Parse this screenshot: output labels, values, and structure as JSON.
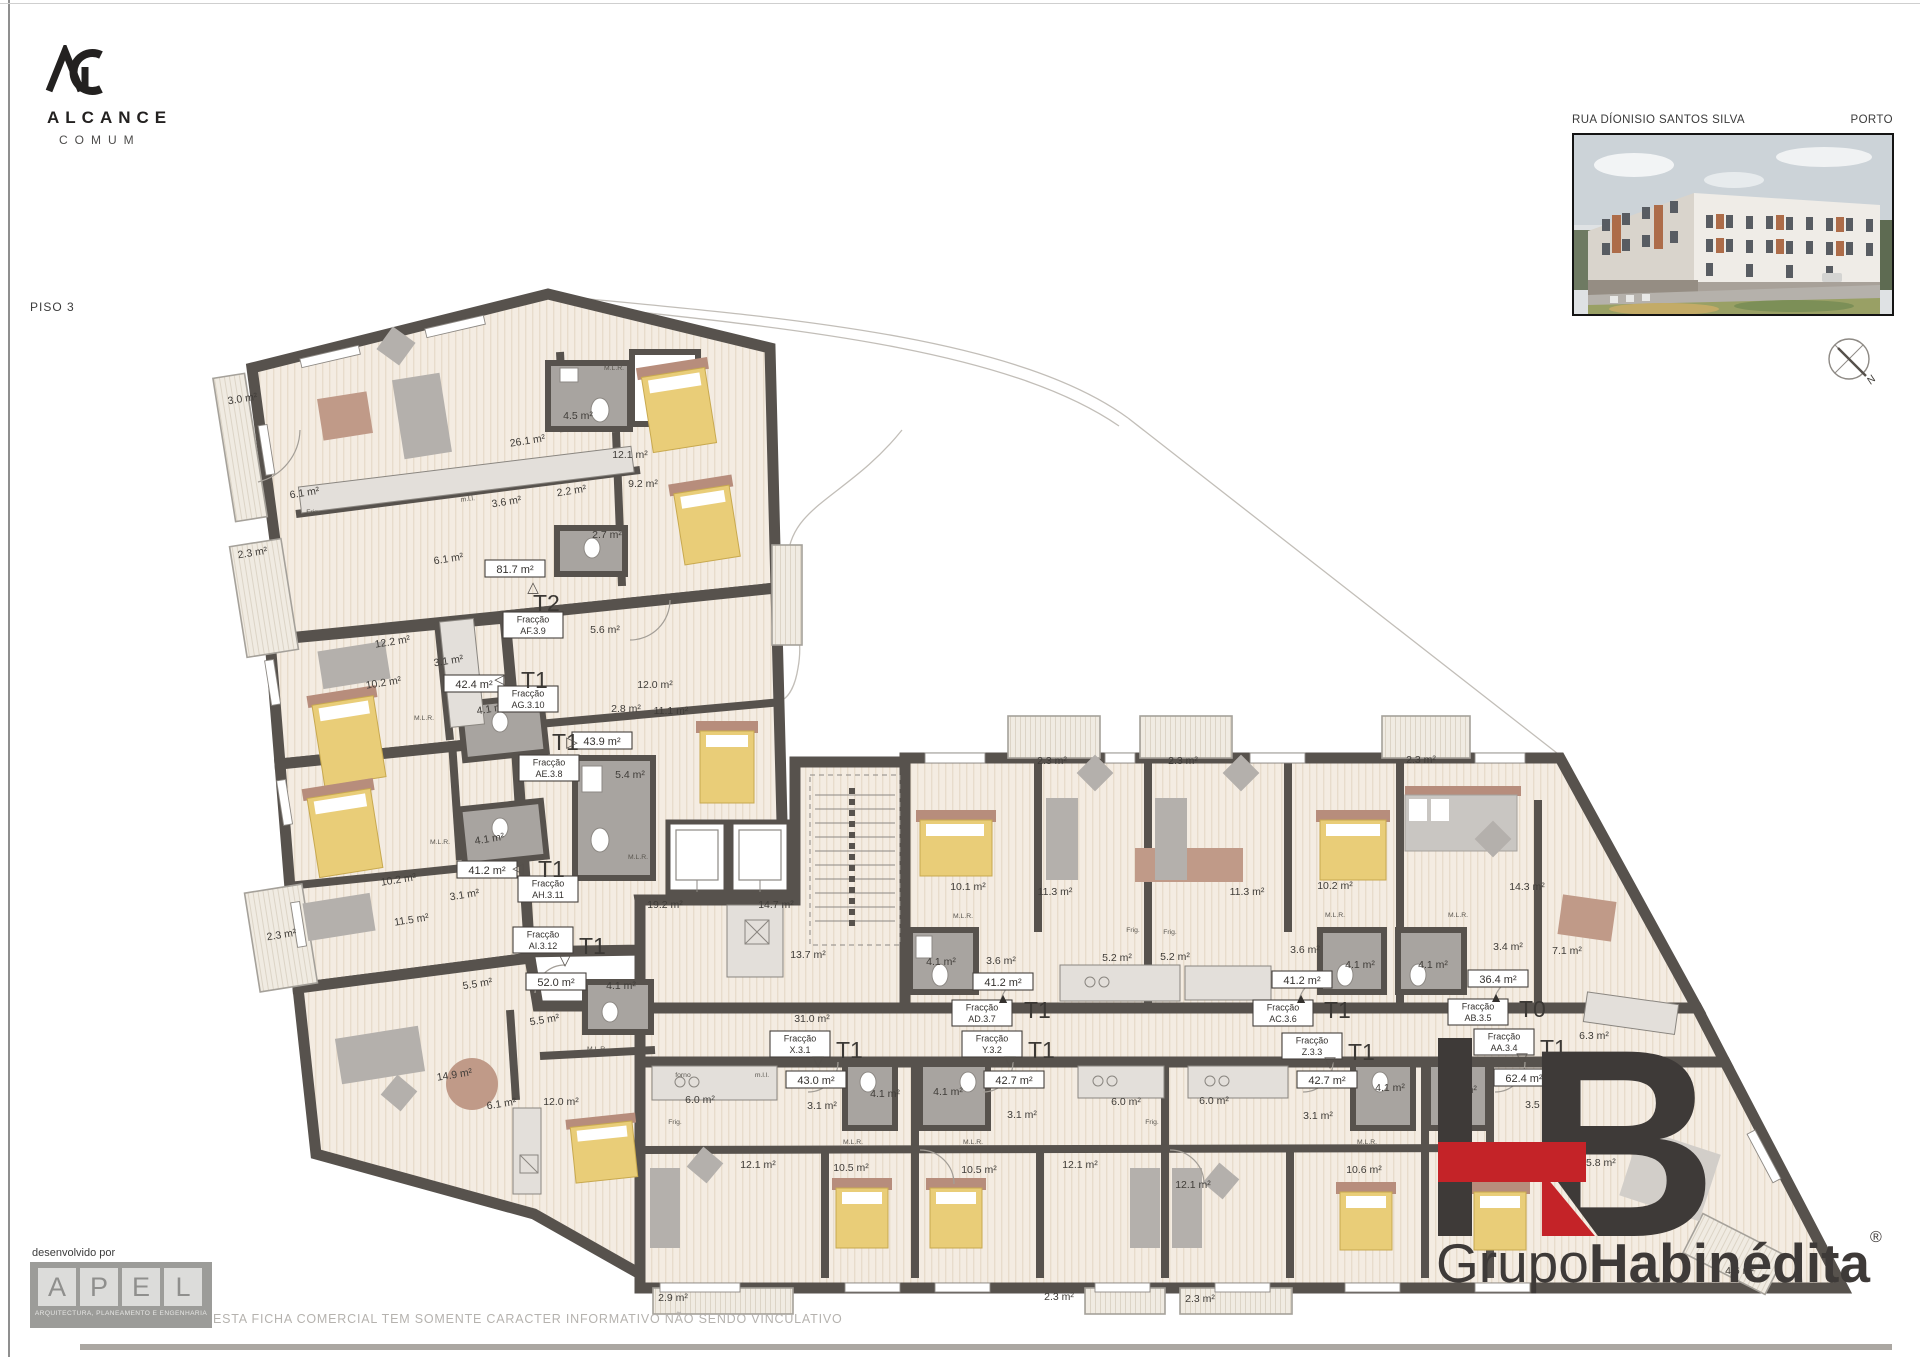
{
  "branding": {
    "monogram": "AC",
    "name": "ALCANCE",
    "subname": "COMUM"
  },
  "sheet": {
    "floor_label": "PISO 3",
    "street": "RUA DÍONISIO SANTOS SILVA",
    "city": "PORTO",
    "compass_label": "N"
  },
  "developer": {
    "label": "desenvolvido por",
    "caption": "ARQUITECTURA, PLANEAMENTO E ENGENHARIA",
    "letters": [
      "A",
      "P",
      "E",
      "L"
    ]
  },
  "legal": {
    "disclaimer": "ESTA FICHA COMERCIAL TEM SOMENTE CARACTER INFORMATIVO NÃO SENDO VINCULATIVO"
  },
  "footer_brand": {
    "monogram": "HB",
    "prefix": "Grupo",
    "name": "Habinédita",
    "registered": "®",
    "accent_color": "#c42328",
    "dark_color": "#3e3a38"
  },
  "plan": {
    "frac_word": "Fracção",
    "units": [
      {
        "code": "AF.3.9",
        "t": "T2",
        "area": "81.7 m²",
        "ax": 515,
        "ay": 569,
        "fx": 533,
        "fy": 625,
        "tx": 533,
        "ty": 603,
        "g": "△",
        "gx": 533,
        "gy": 587,
        "filled": false
      },
      {
        "code": "AG.3.10",
        "t": "T1",
        "area": "42.4 m²",
        "ax": 474,
        "ay": 684,
        "fx": 528,
        "fy": 699,
        "tx": 521,
        "ty": 680,
        "g": "◁",
        "gx": 500,
        "gy": 679,
        "filled": false
      },
      {
        "code": "AE.3.8",
        "t": "T1",
        "area": "43.9 m²",
        "ax": 602,
        "ay": 741,
        "fx": 549,
        "fy": 768,
        "tx": 552,
        "ty": 742,
        "g": "▷",
        "gx": 572,
        "gy": 742,
        "filled": false
      },
      {
        "code": "AH.3.11",
        "t": "T1",
        "area": "41.2 m²",
        "ax": 487,
        "ay": 870,
        "fx": 548,
        "fy": 889,
        "tx": 538,
        "ty": 869,
        "g": "◁",
        "gx": 518,
        "gy": 868,
        "filled": false
      },
      {
        "code": "AI.3.12",
        "t": "T1",
        "area": "52.0 m²",
        "ax": 556,
        "ay": 982,
        "fx": 543,
        "fy": 940,
        "tx": 579,
        "ty": 946,
        "g": "▽",
        "gx": 565,
        "gy": 960,
        "filled": false
      },
      {
        "code": "AD.3.7",
        "t": "T1",
        "area": "41.2 m²",
        "ax": 1003,
        "ay": 982,
        "fx": 982,
        "fy": 1013,
        "tx": 1024,
        "ty": 1010,
        "g": "▲",
        "gx": 1003,
        "gy": 998,
        "filled": true
      },
      {
        "code": "AC.3.6",
        "t": "T1",
        "area": "41.2 m²",
        "ax": 1302,
        "ay": 980,
        "fx": 1283,
        "fy": 1013,
        "tx": 1324,
        "ty": 1010,
        "g": "▲",
        "gx": 1301,
        "gy": 998,
        "filled": true
      },
      {
        "code": "AB.3.5",
        "t": "T0",
        "area": "36.4 m²",
        "ax": 1498,
        "ay": 979,
        "fx": 1478,
        "fy": 1012,
        "tx": 1519,
        "ty": 1009,
        "g": "▲",
        "gx": 1496,
        "gy": 997,
        "filled": true
      },
      {
        "code": "X.3.1",
        "t": "T1",
        "area": "43.0 m²",
        "ax": 816,
        "ay": 1080,
        "fx": 800,
        "fy": 1044,
        "tx": 836,
        "ty": 1050,
        "g": "▽",
        "gx": 818,
        "gy": 1061,
        "filled": false
      },
      {
        "code": "Y.3.2",
        "t": "T1",
        "area": "42.7 m²",
        "ax": 1014,
        "ay": 1080,
        "fx": 992,
        "fy": 1044,
        "tx": 1028,
        "ty": 1050,
        "g": "▽",
        "gx": 1010,
        "gy": 1061,
        "filled": false
      },
      {
        "code": "Z.3.3",
        "t": "T1",
        "area": "42.7 m²",
        "ax": 1327,
        "ay": 1080,
        "fx": 1312,
        "fy": 1046,
        "tx": 1348,
        "ty": 1052,
        "g": "▽",
        "gx": 1330,
        "gy": 1062,
        "filled": false
      },
      {
        "code": "AA.3.4",
        "t": "T1",
        "area": "62.4 m²",
        "ax": 1524,
        "ay": 1078,
        "fx": 1504,
        "fy": 1042,
        "tx": 1540,
        "ty": 1048,
        "g": "▽",
        "gx": 1522,
        "gy": 1058,
        "filled": false
      }
    ],
    "area_labels": [
      {
        "x": 243,
        "y": 402,
        "t": "3.0 m²",
        "r": -9
      },
      {
        "x": 528,
        "y": 444,
        "t": "26.1 m²",
        "r": -9
      },
      {
        "x": 578,
        "y": 419,
        "t": "4.5 m²"
      },
      {
        "x": 630,
        "y": 458,
        "t": "12.1 m²"
      },
      {
        "x": 305,
        "y": 496,
        "t": "6.1 m²",
        "r": -9
      },
      {
        "x": 507,
        "y": 505,
        "t": "3.6 m²",
        "r": -9
      },
      {
        "x": 572,
        "y": 494,
        "t": "2.2 m²",
        "r": -9
      },
      {
        "x": 643,
        "y": 487,
        "t": "9.2 m²"
      },
      {
        "x": 253,
        "y": 556,
        "t": "2.3 m²",
        "r": -9
      },
      {
        "x": 607,
        "y": 538,
        "t": "2.7 m²"
      },
      {
        "x": 449,
        "y": 562,
        "t": "6.1 m²",
        "r": -9
      },
      {
        "x": 605,
        "y": 633,
        "t": "5.6 m²"
      },
      {
        "x": 393,
        "y": 645,
        "t": "12.2 m²",
        "r": -9
      },
      {
        "x": 449,
        "y": 664,
        "t": "3.1 m²",
        "r": -9
      },
      {
        "x": 384,
        "y": 686,
        "t": "10.2 m²",
        "r": -9
      },
      {
        "x": 655,
        "y": 688,
        "t": "12.0 m²"
      },
      {
        "x": 492,
        "y": 712,
        "t": "4.1 m²",
        "r": -9
      },
      {
        "x": 626,
        "y": 712,
        "t": "2.8 m²"
      },
      {
        "x": 671,
        "y": 714,
        "t": "11.1 m²"
      },
      {
        "x": 630,
        "y": 778,
        "t": "5.4 m²"
      },
      {
        "x": 399,
        "y": 883,
        "t": "10.2 m²",
        "r": -9
      },
      {
        "x": 490,
        "y": 842,
        "t": "4.1 m²",
        "r": -9
      },
      {
        "x": 465,
        "y": 898,
        "t": "3.1 m²",
        "r": -9
      },
      {
        "x": 412,
        "y": 923,
        "t": "11.5 m²",
        "r": -9
      },
      {
        "x": 282,
        "y": 938,
        "t": "2.3 m²",
        "r": -9
      },
      {
        "x": 478,
        "y": 987,
        "t": "5.5 m²",
        "r": -9
      },
      {
        "x": 545,
        "y": 1023,
        "t": "5.5 m²",
        "r": -9
      },
      {
        "x": 621,
        "y": 989,
        "t": "4.1 m²"
      },
      {
        "x": 455,
        "y": 1078,
        "t": "14.9 m²",
        "r": -9
      },
      {
        "x": 502,
        "y": 1107,
        "t": "6.1 m²",
        "r": -9
      },
      {
        "x": 561,
        "y": 1105,
        "t": "12.0 m²"
      },
      {
        "x": 673,
        "y": 1301,
        "t": "2.9 m²"
      },
      {
        "x": 665,
        "y": 908,
        "t": "19.2 m²"
      },
      {
        "x": 776,
        "y": 908,
        "t": "14.7 m²"
      },
      {
        "x": 808,
        "y": 958,
        "t": "13.7 m²"
      },
      {
        "x": 812,
        "y": 1022,
        "t": "31.0 m²"
      },
      {
        "x": 1052,
        "y": 764,
        "t": "2.3 m²"
      },
      {
        "x": 1183,
        "y": 764,
        "t": "2.3 m²"
      },
      {
        "x": 1421,
        "y": 763,
        "t": "2.3 m²"
      },
      {
        "x": 968,
        "y": 890,
        "t": "10.1 m²"
      },
      {
        "x": 1055,
        "y": 895,
        "t": "11.3 m²"
      },
      {
        "x": 941,
        "y": 965,
        "t": "4.1 m²"
      },
      {
        "x": 1001,
        "y": 964,
        "t": "3.6 m²"
      },
      {
        "x": 1117,
        "y": 961,
        "t": "5.2 m²"
      },
      {
        "x": 1175,
        "y": 960,
        "t": "5.2 m²"
      },
      {
        "x": 1247,
        "y": 895,
        "t": "11.3 m²"
      },
      {
        "x": 1335,
        "y": 889,
        "t": "10.2 m²"
      },
      {
        "x": 1527,
        "y": 890,
        "t": "14.3 m²"
      },
      {
        "x": 1305,
        "y": 953,
        "t": "3.6 m²"
      },
      {
        "x": 1360,
        "y": 968,
        "t": "4.1 m²"
      },
      {
        "x": 1433,
        "y": 968,
        "t": "4.1 m²"
      },
      {
        "x": 1508,
        "y": 950,
        "t": "3.4 m²"
      },
      {
        "x": 1567,
        "y": 954,
        "t": "7.1 m²"
      },
      {
        "x": 700,
        "y": 1103,
        "t": "6.0 m²"
      },
      {
        "x": 822,
        "y": 1109,
        "t": "3.1 m²"
      },
      {
        "x": 885,
        "y": 1097,
        "t": "4.1 m²"
      },
      {
        "x": 948,
        "y": 1095,
        "t": "4.1 m²"
      },
      {
        "x": 758,
        "y": 1168,
        "t": "12.1 m²"
      },
      {
        "x": 851,
        "y": 1171,
        "t": "10.5 m²"
      },
      {
        "x": 979,
        "y": 1173,
        "t": "10.5 m²"
      },
      {
        "x": 1022,
        "y": 1118,
        "t": "3.1 m²"
      },
      {
        "x": 1126,
        "y": 1105,
        "t": "6.0 m²"
      },
      {
        "x": 1214,
        "y": 1104,
        "t": "6.0 m²"
      },
      {
        "x": 1080,
        "y": 1168,
        "t": "12.1 m²"
      },
      {
        "x": 1193,
        "y": 1188,
        "t": "12.1 m²"
      },
      {
        "x": 1318,
        "y": 1119,
        "t": "3.1 m²"
      },
      {
        "x": 1364,
        "y": 1173,
        "t": "10.6 m²"
      },
      {
        "x": 1390,
        "y": 1091,
        "t": "4.1 m²"
      },
      {
        "x": 1462,
        "y": 1093,
        "t": "4.1 m²"
      },
      {
        "x": 1059,
        "y": 1300,
        "t": "2.3 m²"
      },
      {
        "x": 1200,
        "y": 1302,
        "t": "2.3 m²"
      },
      {
        "x": 1490,
        "y": 1171,
        "t": "11.8 m²"
      },
      {
        "x": 1540,
        "y": 1108,
        "t": "3.5 m²"
      },
      {
        "x": 1594,
        "y": 1039,
        "t": "6.3 m²"
      },
      {
        "x": 1598,
        "y": 1166,
        "t": "25.8 m²"
      },
      {
        "x": 1740,
        "y": 1274,
        "t": "4.6 m²"
      }
    ],
    "small_labels": [
      {
        "x": 614,
        "y": 370,
        "t": "M.L.R."
      },
      {
        "x": 424,
        "y": 720,
        "t": "M.L.R."
      },
      {
        "x": 440,
        "y": 844,
        "t": "M.L.R."
      },
      {
        "x": 638,
        "y": 859,
        "t": "M.L.R."
      },
      {
        "x": 597,
        "y": 1051,
        "t": "M.L.R."
      },
      {
        "x": 963,
        "y": 918,
        "t": "M.L.R."
      },
      {
        "x": 1335,
        "y": 917,
        "t": "M.L.R."
      },
      {
        "x": 1458,
        "y": 917,
        "t": "M.L.R."
      },
      {
        "x": 853,
        "y": 1144,
        "t": "M.L.R."
      },
      {
        "x": 973,
        "y": 1144,
        "t": "M.L.R."
      },
      {
        "x": 1367,
        "y": 1144,
        "t": "M.L.R."
      },
      {
        "x": 313,
        "y": 514,
        "t": "Frig."
      },
      {
        "x": 1133,
        "y": 932,
        "t": "Frig."
      },
      {
        "x": 1170,
        "y": 934,
        "t": "Frig."
      },
      {
        "x": 675,
        "y": 1124,
        "t": "Frig."
      },
      {
        "x": 1152,
        "y": 1124,
        "t": "Frig."
      },
      {
        "x": 468,
        "y": 501,
        "t": "m.l.l.",
        "r": -7
      },
      {
        "x": 683,
        "y": 1077,
        "t": "forno"
      },
      {
        "x": 762,
        "y": 1077,
        "t": "m.l.l."
      }
    ]
  }
}
